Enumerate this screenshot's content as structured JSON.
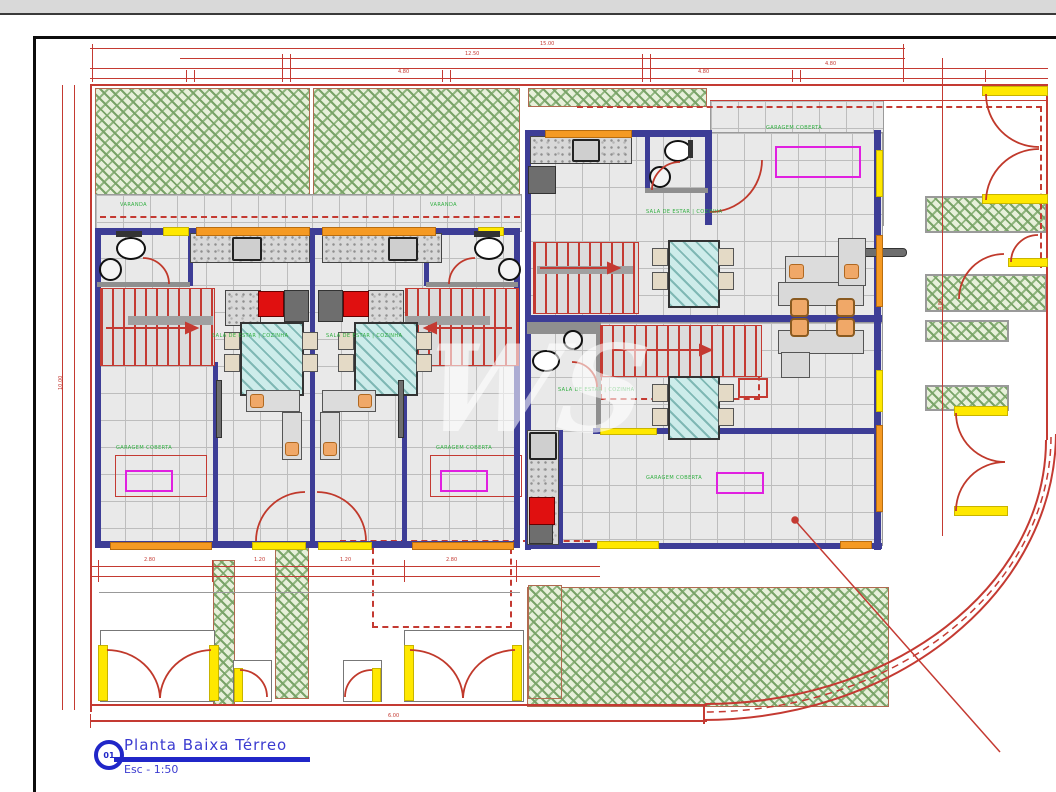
{
  "sheet": {
    "number": "01",
    "title": "Planta Baixa Térreo",
    "scale": "Esc - 1:50",
    "watermark": "WS"
  },
  "drawing": {
    "type": "architectural-floor-plan",
    "colors": {
      "wall": "#3d3d96",
      "dimension": "#c43a32",
      "garden": "#8fb57e",
      "opening_yellow": "#ffe800",
      "window_orange": "#f59a23",
      "label_green": "#2fae3f",
      "label_magenta": "#e020e0",
      "title_blue": "#2026c8"
    }
  },
  "room_labels": [
    {
      "text": "SALA DE ESTAR | COZINHA"
    },
    {
      "text": "SALA DE ESTAR | COZINHA"
    },
    {
      "text": "SALA DE ESTAR | COZINHA"
    },
    {
      "text": "SALA DE ESTAR | COZINHA"
    },
    {
      "text": "GARAGEM COBERTA"
    },
    {
      "text": "GARAGEM COBERTA"
    },
    {
      "text": "GARAGEM COBERTA"
    },
    {
      "text": "GARAGEM COBERTA"
    },
    {
      "text": "VARANDA"
    },
    {
      "text": "VARANDA"
    }
  ],
  "dim_labels": [
    {
      "text": "6.00"
    },
    {
      "text": "2.80"
    },
    {
      "text": "1.20"
    },
    {
      "text": "1.20"
    },
    {
      "text": "2.80"
    },
    {
      "text": "4.80"
    },
    {
      "text": "4.80"
    },
    {
      "text": "15.00"
    },
    {
      "text": "12.50"
    },
    {
      "text": "10.00"
    },
    {
      "text": "4.80"
    },
    {
      "text": "4.80"
    }
  ]
}
